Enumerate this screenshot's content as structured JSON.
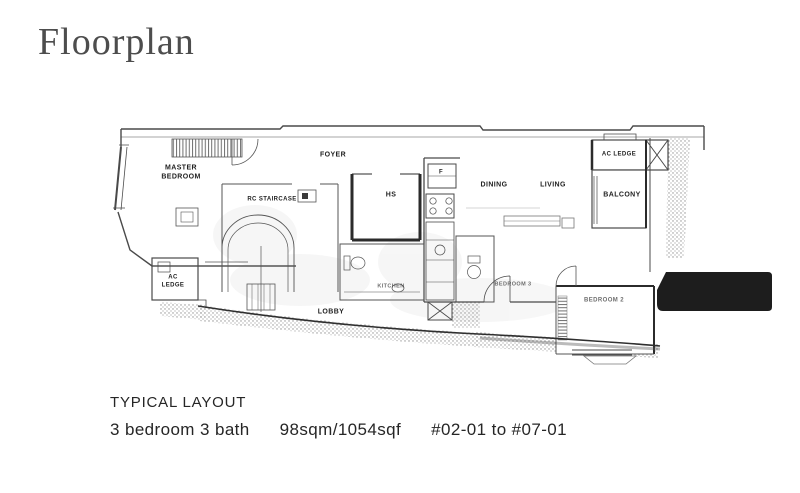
{
  "page": {
    "title": "Floorplan"
  },
  "plan": {
    "labels": [
      {
        "name": "master-bedroom",
        "text": "MASTER\nBEDROOM"
      },
      {
        "name": "foyer",
        "text": "FOYER"
      },
      {
        "name": "rc-staircase",
        "text": "RC STAIRCASE"
      },
      {
        "name": "hs",
        "text": "HS"
      },
      {
        "name": "fridge",
        "text": "F"
      },
      {
        "name": "dining",
        "text": "DINING"
      },
      {
        "name": "living",
        "text": "LIVING"
      },
      {
        "name": "ac-ledge-right",
        "text": "AC LEDGE"
      },
      {
        "name": "balcony",
        "text": "BALCONY"
      },
      {
        "name": "ac-ledge-left",
        "text": "AC\nLEDGE"
      },
      {
        "name": "kitchen",
        "text": "KITCHEN"
      },
      {
        "name": "bedroom-3",
        "text": "BEDROOM 3"
      },
      {
        "name": "lobby",
        "text": "LOBBY"
      },
      {
        "name": "bedroom-2",
        "text": "BEDROOM 2"
      }
    ]
  },
  "footer": {
    "layout_label": "TYPICAL LAYOUT",
    "unit_type": "3 bedroom 3 bath",
    "area": "98sqm/1054sqf",
    "units_range": "#02-01 to #07-01"
  },
  "colors": {
    "title_text": "#4d4d4d",
    "body_text": "#262626",
    "plan_line": "#5f5f5f",
    "plan_wall": "#2b2b2b",
    "black_bar": "#1d1d1d"
  }
}
